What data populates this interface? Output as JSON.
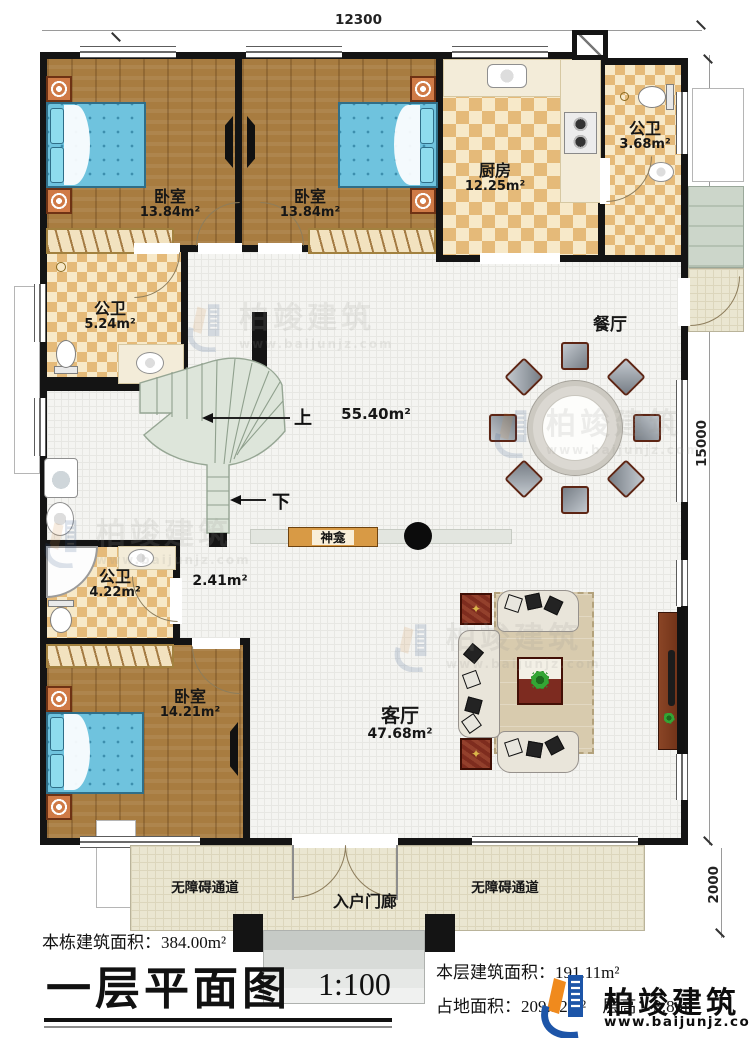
{
  "dimensions": {
    "top": "12300",
    "right": "15000",
    "porch": "2000"
  },
  "rooms": {
    "bedroom_tl": {
      "name": "卧室",
      "area": "13.84m²"
    },
    "bedroom_tm": {
      "name": "卧室",
      "area": "13.84m²"
    },
    "kitchen": {
      "name": "厨房",
      "area": "12.25m²"
    },
    "bath_tr": {
      "name": "公卫",
      "area": "3.68m²"
    },
    "bath_ml": {
      "name": "公卫",
      "area": "5.24m²"
    },
    "bath_bl": {
      "name": "公卫",
      "area": "4.22m²"
    },
    "bedroom_b": {
      "name": "卧室",
      "area": "14.21m²"
    },
    "dining": {
      "name": "餐厅"
    },
    "living": {
      "name": "客厅",
      "area": "47.68m²"
    },
    "hall": {
      "area": "55.40m²"
    },
    "corridor": {
      "area": "2.41m²"
    },
    "shrine": {
      "name": "神龛"
    },
    "porch": {
      "name": "入户门廊"
    },
    "ramp_left": {
      "name": "无障碍通道"
    },
    "ramp_right": {
      "name": "无障碍通道"
    }
  },
  "stairs": {
    "up": "上",
    "down": "下"
  },
  "title_block": {
    "building_total_label": "本栋建筑面积：",
    "building_total_value": "384.00m²",
    "plan_title": "一层平面图",
    "scale": "1:100",
    "floor_area_label": "本层建筑面积：",
    "floor_area_value": "191.11m²",
    "land_area_label": "占地面积：",
    "land_area_value": "209.32m²",
    "floor_height_label": "层高：",
    "floor_height_value": "3.8m"
  },
  "logo": {
    "name": "柏竣建筑",
    "website": "www.baijunjz.com"
  },
  "watermark": {
    "name": "柏竣建筑",
    "website": "www.baijunjz.com"
  },
  "colors": {
    "accent_blue": "#1d55a8",
    "accent_orange": "#f08a1d",
    "wall": "#141414"
  }
}
